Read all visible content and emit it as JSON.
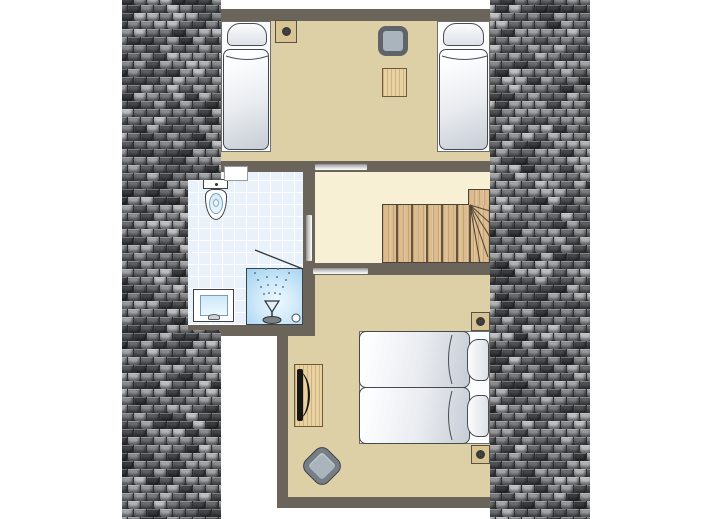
{
  "scene": {
    "kind": "floor-plan",
    "text_labels": []
  },
  "rooms": [
    {
      "name": "bedroom-top",
      "furniture": [
        "single-bed-left",
        "single-bed-right",
        "armchair",
        "side-table",
        "ceiling-spotlight"
      ]
    },
    {
      "name": "bathroom",
      "furniture": [
        "toilet",
        "washbasin",
        "shower"
      ]
    },
    {
      "name": "landing",
      "furniture": [
        "staircase-with-winders"
      ]
    },
    {
      "name": "bedroom-bottom",
      "furniture": [
        "twin-beds",
        "tv-cabinet",
        "armchair",
        "ceiling-spotlight",
        "ceiling-spotlight"
      ]
    }
  ],
  "colors": {
    "wall": "#6b645a",
    "floor_room": "#ddd0a6",
    "floor_hall": "#f8f0d5",
    "floor_bath": "#e9f2fa",
    "outline": "#45484d",
    "bed_white": "#fbfcfd",
    "bed_shade": "#c9cfd7",
    "pillow_shade": "#dde2e8",
    "wood": "#e9d2a2",
    "stair_wood": "#dcbc8e",
    "stair_line": "#4d4233",
    "chair_frame_dark": "#5f6468",
    "chair_frame_light": "#787e85",
    "chair_seat": "#a9b4bd",
    "spot_plate": "#d8c492",
    "spot_ring": "#3a3a3a",
    "spot_inner": "#cfc49a",
    "shower_edge": "#9fd0ef",
    "basin_blue": "#cde8f8",
    "fixture_border": "#3d4044"
  },
  "roof": {
    "tile_width": 13,
    "tile_height": 8,
    "palette": [
      "#3a3c3f",
      "#45474a",
      "#505255",
      "#5c5e61",
      "#6b6d70",
      "#6b6d70",
      "#7a7c7f",
      "#8a8c8f",
      "#8a8c8f",
      "#97999c",
      "#a4a6a9",
      "#a4a6a9",
      "#b2b4b7",
      "#bfc1c4"
    ]
  }
}
